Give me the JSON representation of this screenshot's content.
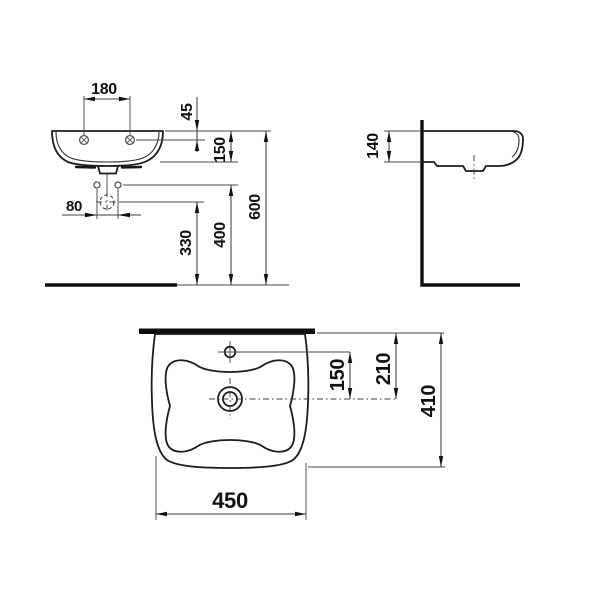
{
  "colors": {
    "background": "#ffffff",
    "line": "#1c1c1c",
    "dimension_line": "#3c3c3c",
    "text": "#111111"
  },
  "views": {
    "front": {
      "dims": {
        "mount_hole_spacing": "180",
        "rim_to_mount_holes": "45",
        "rim_to_body_bottom": "150",
        "floor_to_rim": "600",
        "fixing_bolt_spacing": "80",
        "floor_to_drain": "330",
        "floor_to_fixing_bolts": "400"
      }
    },
    "side": {
      "dims": {
        "rim_to_underside": "140"
      }
    },
    "top": {
      "dims": {
        "tap_hole_to_drain": "150",
        "back_edge_to_drain": "210",
        "overall_depth": "410",
        "overall_width": "450"
      }
    }
  }
}
